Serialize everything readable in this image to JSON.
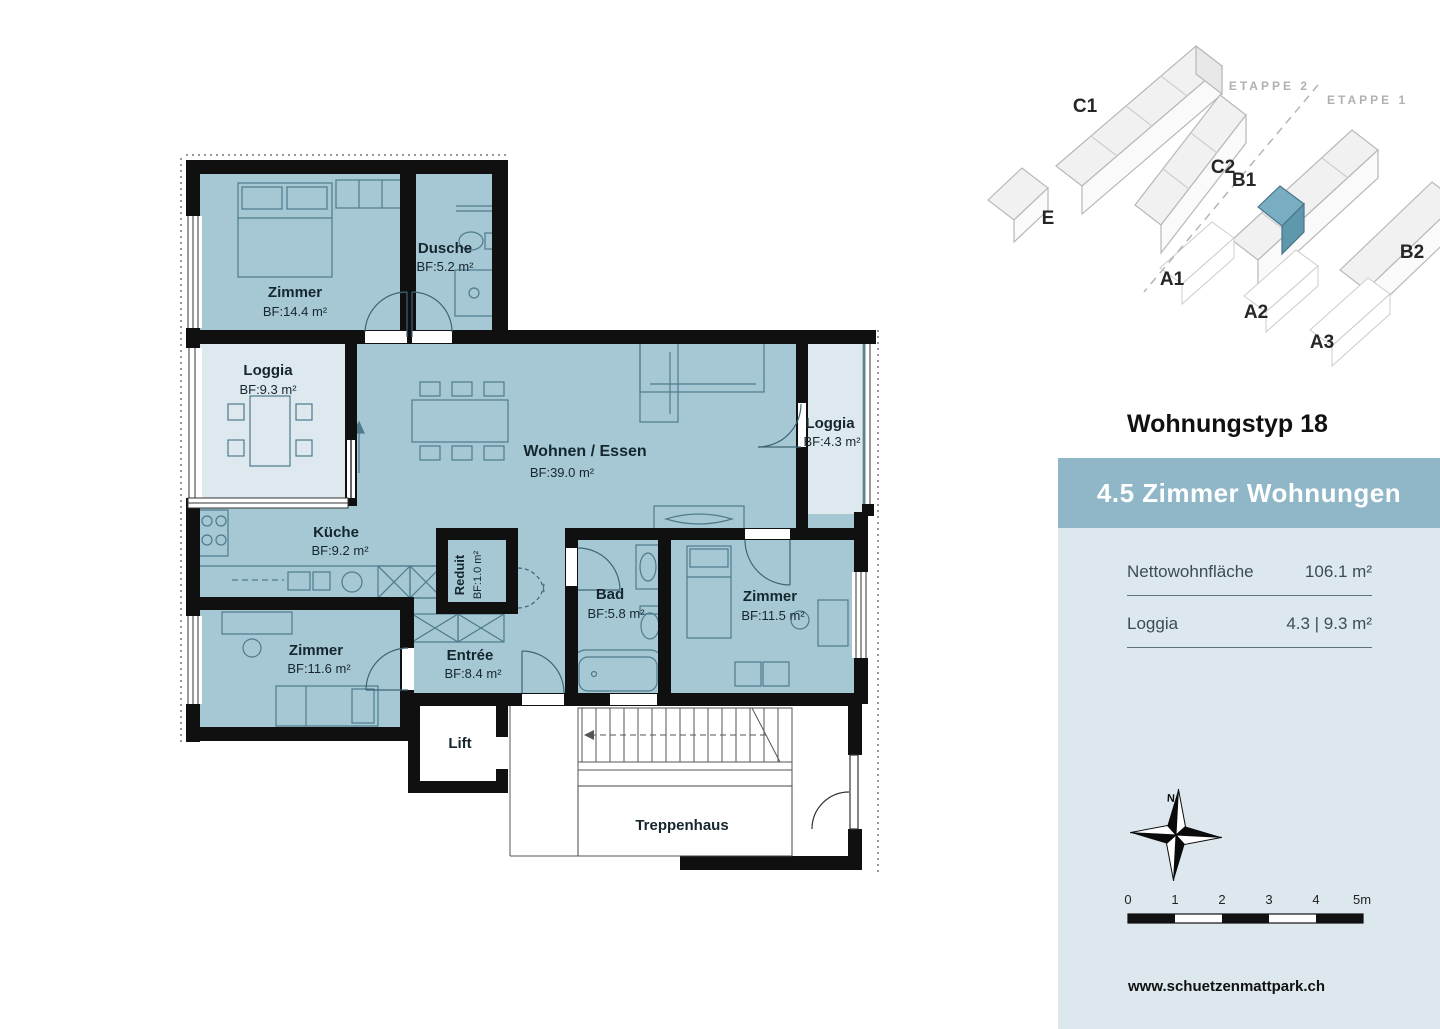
{
  "floorplan": {
    "rooms": [
      {
        "name": "Zimmer",
        "area": "BF:14.4 m²"
      },
      {
        "name": "Dusche",
        "area": "BF:5.2 m²"
      },
      {
        "name": "Loggia",
        "area": "BF:9.3 m²"
      },
      {
        "name": "Wohnen / Essen",
        "area": "BF:39.0 m²"
      },
      {
        "name": "Loggia",
        "area": "BF:4.3 m²"
      },
      {
        "name": "Küche",
        "area": "BF:9.2 m²"
      },
      {
        "name": "Reduit",
        "area": "BF:1.0 m²"
      },
      {
        "name": "Bad",
        "area": "BF:5.8 m²"
      },
      {
        "name": "Zimmer",
        "area": "BF:11.5 m²"
      },
      {
        "name": "Zimmer",
        "area": "BF:11.6 m²"
      },
      {
        "name": "Entrée",
        "area": "BF:8.4 m²"
      },
      {
        "name": "Lift",
        "area": ""
      },
      {
        "name": "Treppenhaus",
        "area": ""
      }
    ],
    "colors": {
      "room_fill": "#a6c8d5",
      "loggia_fill": "#dde9ee",
      "wall": "#101010",
      "furniture_line": "#4e7a8c"
    }
  },
  "siteplan": {
    "buildings": [
      "C1",
      "C2",
      "B1",
      "B2",
      "E",
      "A1",
      "A2",
      "A3"
    ],
    "etappe_2": "ETAPPE 2",
    "etappe_1": "ETAPPE 1",
    "highlight_color": "#79aec2"
  },
  "panel": {
    "title": "Wohnungstyp 18",
    "header": "4.5 Zimmer Wohnungen",
    "rows": [
      {
        "label": "Nettowohnfläche",
        "value": "106.1 m²"
      },
      {
        "label": "Loggia",
        "value": "4.3 | 9.3 m²"
      }
    ],
    "colors": {
      "header_bg": "#8fb7c8",
      "body_bg": "#dce8ee"
    }
  },
  "compass": {
    "north": "N"
  },
  "scalebar": {
    "labels": [
      "0",
      "1",
      "2",
      "3",
      "4",
      "5m"
    ]
  },
  "footer": {
    "website": "www.schuetzenmattpark.ch"
  }
}
